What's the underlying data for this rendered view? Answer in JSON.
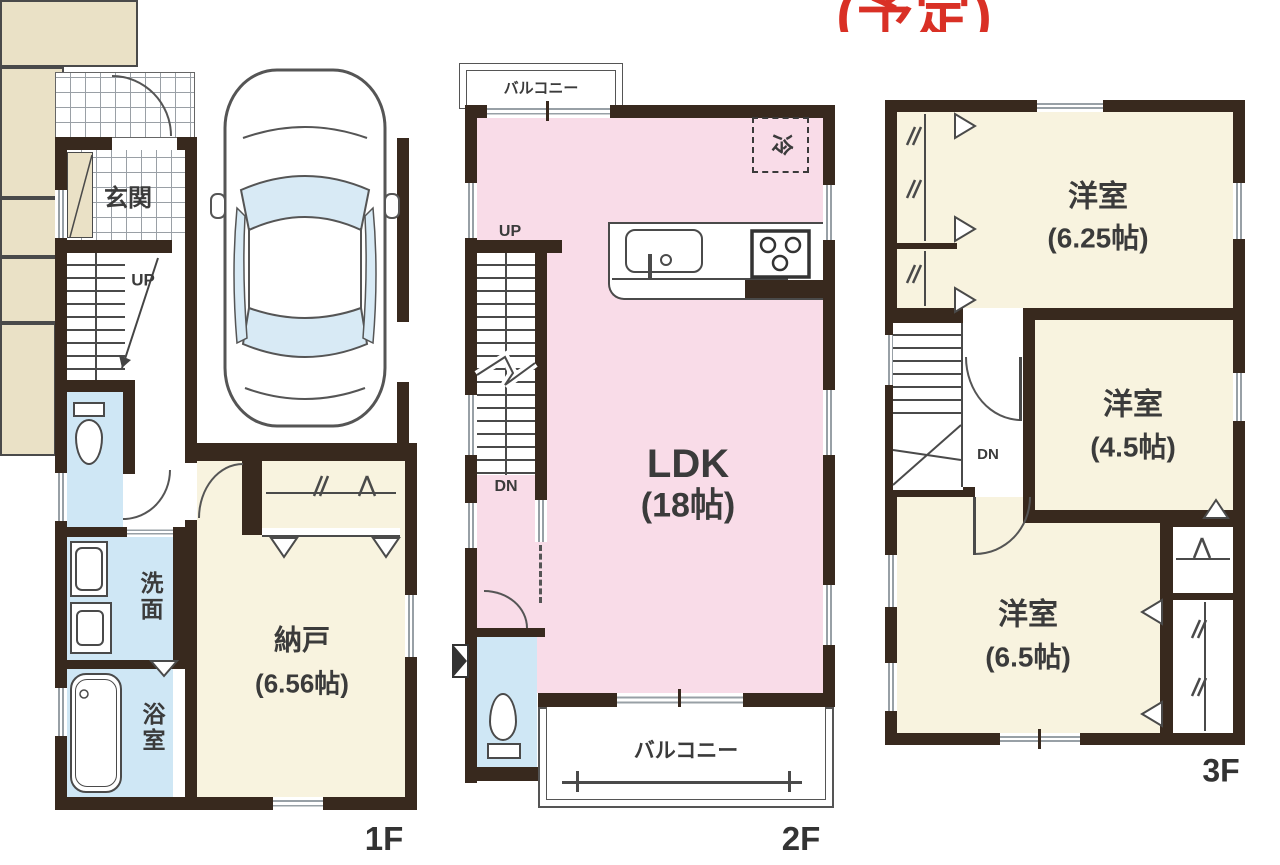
{
  "annotation": {
    "text": "(予定)",
    "color": "#d93025"
  },
  "floor1": {
    "label": "1F",
    "genkan": "玄関",
    "up": "UP",
    "senmen": "洗面",
    "yokushitsu": "浴室",
    "nando": "納戸",
    "nando_size": "(6.56帖)"
  },
  "floor2": {
    "label": "2F",
    "balcony_top": "バルコニー",
    "fridge": "冷",
    "up": "UP",
    "dn": "DN",
    "ldk": "LDK",
    "ldk_size": "(18帖)",
    "balcony_bottom": "バルコニー"
  },
  "floor3": {
    "label": "3F",
    "dn": "DN",
    "rooms": [
      {
        "name": "洋室",
        "size": "(6.25帖)"
      },
      {
        "name": "洋室",
        "size": "(4.5帖)"
      },
      {
        "name": "洋室",
        "size": "(6.5帖)"
      }
    ]
  },
  "colors": {
    "wall": "#38291e",
    "wet_area": "#cfe7f5",
    "ldk": "#f9dce8",
    "room": "#f8f3df",
    "closet": "#eae1c6",
    "annotation": "#d93025"
  }
}
